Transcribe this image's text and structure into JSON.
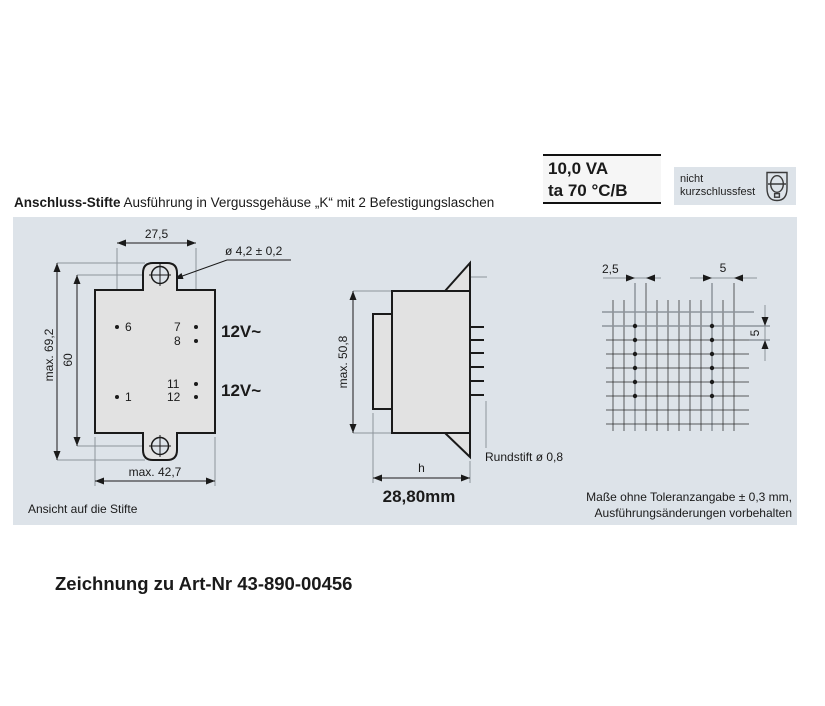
{
  "spec_box": {
    "line1": "10,0 VA",
    "line2": "ta 70 °C/B"
  },
  "warning_box": {
    "line1": "nicht",
    "line2": "kurzschlussfest",
    "icon": "transformer-shield-icon"
  },
  "header": {
    "title": "Anschluss-Stifte",
    "subtitle": "Ausführung in Vergussgehäuse „K“ mit 2 Befestigungslaschen"
  },
  "front_view": {
    "dim_pin_span": "27,5",
    "hole_dia": "ø 4,2 ± 0,2",
    "dim_height_max": "max. 69,2",
    "dim_hole_centers": "60",
    "dim_width_max": "max. 42,7",
    "pins": {
      "p6": "6",
      "p7": "7",
      "p8": "8",
      "p11": "11",
      "p12": "12",
      "p1": "1"
    },
    "winding_top": "12V~",
    "winding_bottom": "12V~",
    "caption": "Ansicht auf die Stifte"
  },
  "side_view": {
    "dim_height": "max. 50,8",
    "dim_depth": "h",
    "depth_value": "28,80mm",
    "pin_note": "Rundstift ø 0,8"
  },
  "grid_view": {
    "dim_pitch_small": "2,5",
    "dim_pitch_top": "5",
    "dim_pitch_right": "5"
  },
  "footer": {
    "tolerance_line1": "Maße ohne Toleranzangabe ± 0,3 mm,",
    "tolerance_line2": "Ausführungsänderungen vorbehalten"
  },
  "title_block": {
    "drawing_title": "Zeichnung zu Art-Nr 43-890-00456"
  },
  "colors": {
    "panel_bg": "#dde3e9",
    "body_fill": "#e2e2e2",
    "line": "#1a1a1a",
    "ext_line": "#8d949c"
  }
}
